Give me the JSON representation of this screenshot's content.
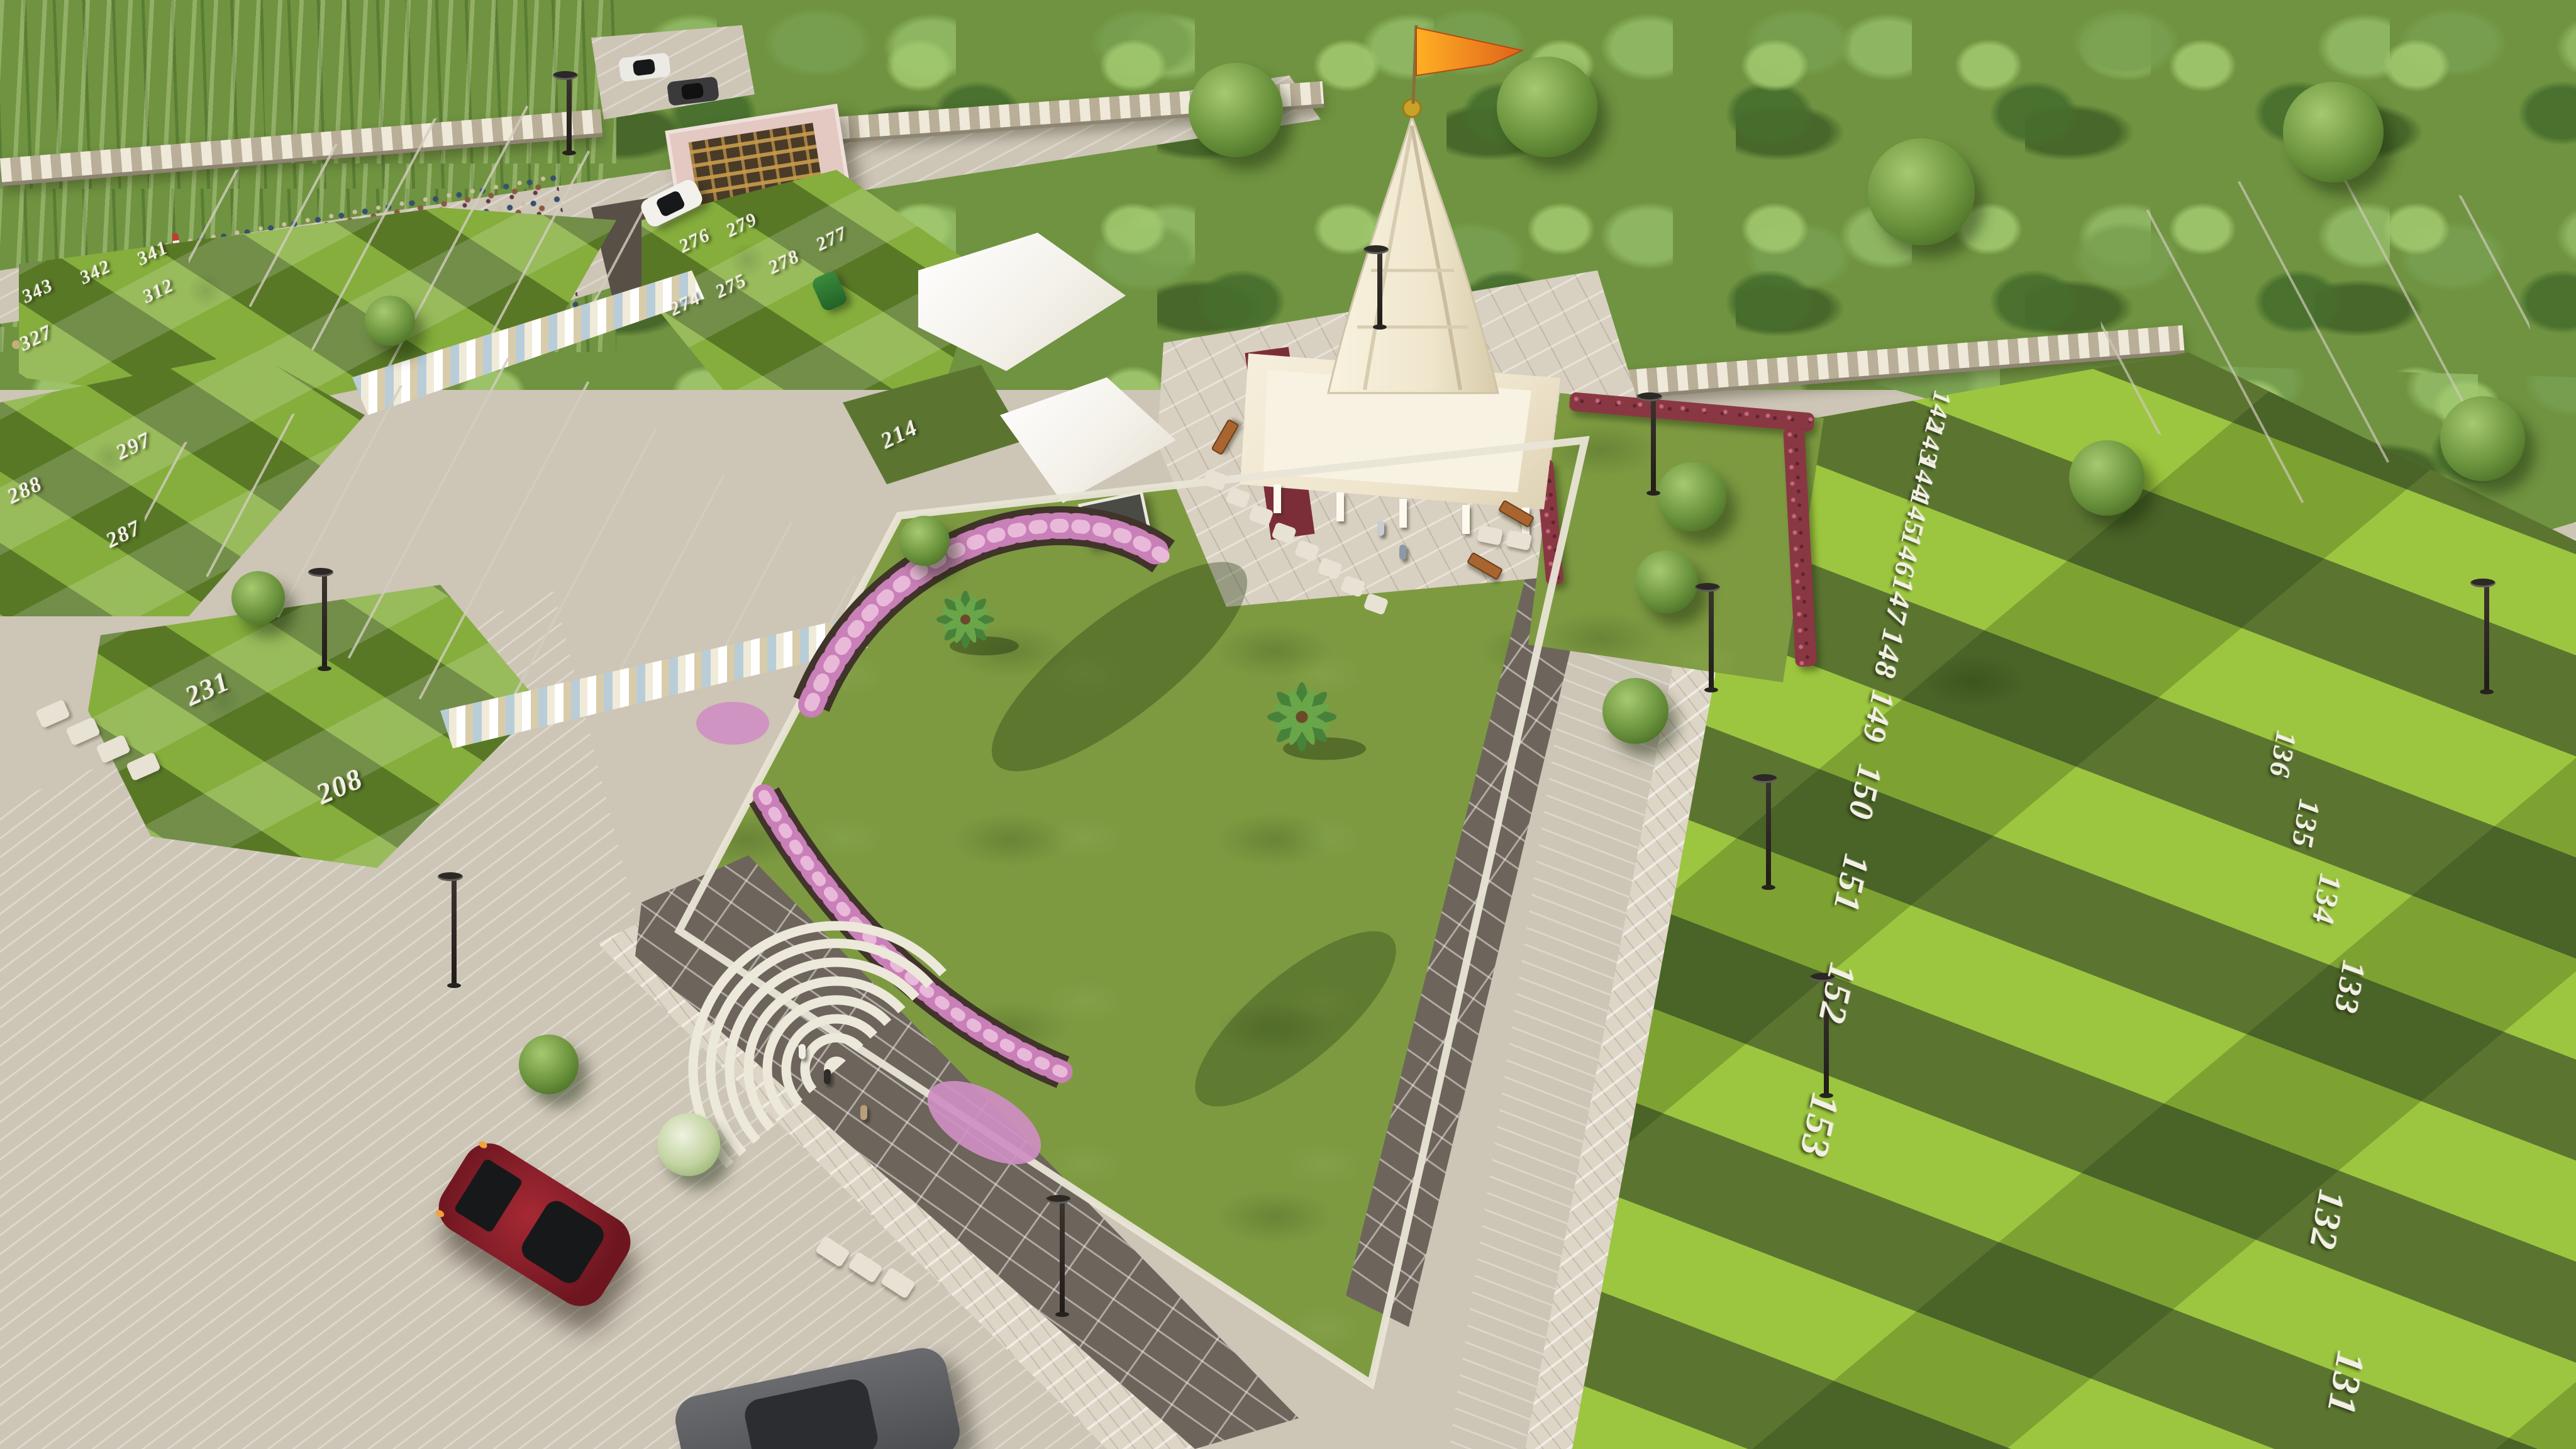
{
  "scene": {
    "description": "Aerial 3D render of a residential township: central landscaped park with concentric-arc plaza and flower beds, cream Hindu temple with saffron flag, white row-house buildings, numbered green plots, paved roads, event lawn with stage and crowd, red sports car",
    "temple": {
      "flag": "saffron pennant",
      "structure": "shikhara tower on columned pavilion"
    },
    "vehicles": {
      "sports_car": "dark red",
      "sedan_bottom": "gray",
      "parked_car": "white",
      "rickshaw": "green"
    },
    "colors": {
      "grass_light": "#9cc63f",
      "grass_dark": "#5b7531",
      "park_lawn": "#7d9a41",
      "road": "#cdc5b6",
      "paver_dark": "#6d645c",
      "sidewalk": "#ddd5c6",
      "building_white": "#f4f1ea",
      "temple_cream": "#f3ead4",
      "flag_saffron": "#f6921e",
      "flower_pink": "#cf8ec2",
      "hedge_red": "#8a3744",
      "forest_green": "#6f9340",
      "car_red": "#8e2029",
      "soil_brown": "#41342a",
      "plot_number_white": "#f2efe4"
    }
  },
  "plots": {
    "event_block": [
      "341",
      "342",
      "343",
      "312",
      "327"
    ],
    "near_buildings": [
      "297",
      "288",
      "287"
    ],
    "lower_left": [
      "231",
      "208"
    ],
    "corner": [
      "214"
    ],
    "mid_block": [
      "276",
      "279",
      "278",
      "277",
      "275",
      "274"
    ],
    "right_col_a": [
      "142",
      "143",
      "144",
      "145",
      "146",
      "147",
      "148",
      "149",
      "150",
      "151",
      "152",
      "153"
    ],
    "right_col_b": [
      "136",
      "135",
      "134",
      "133",
      "132",
      "131"
    ]
  }
}
